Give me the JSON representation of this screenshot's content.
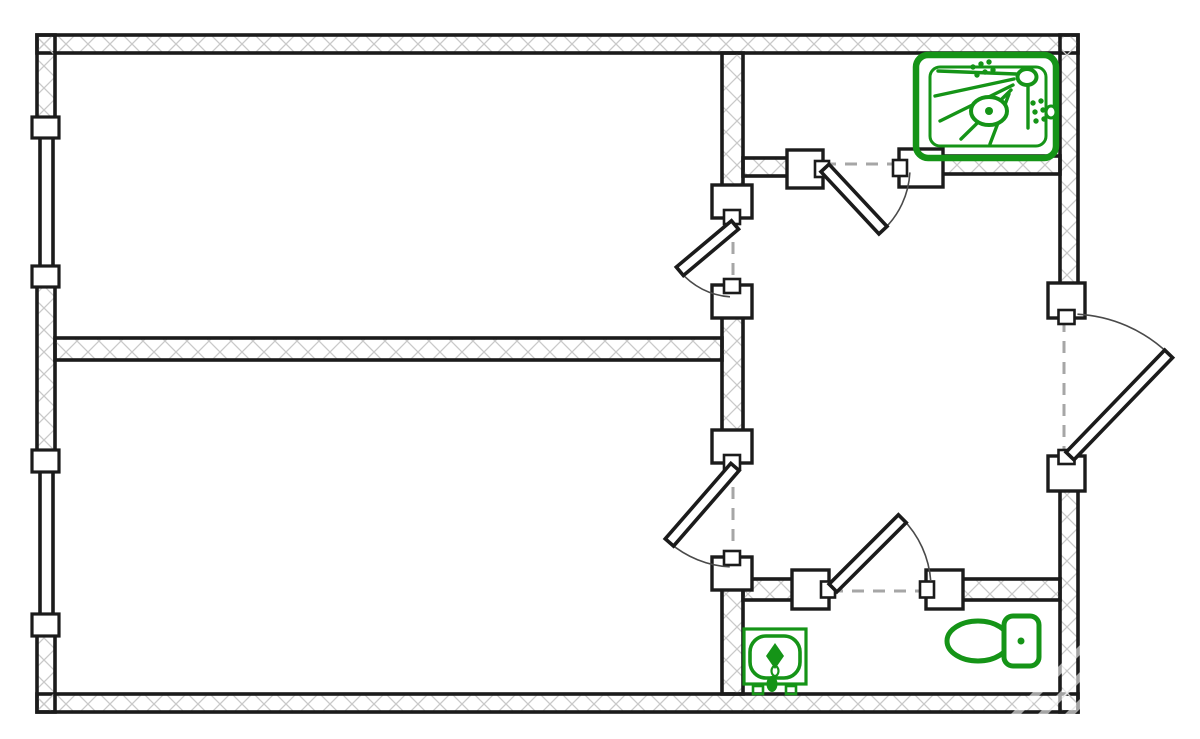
{
  "meta": {
    "name": "apartment-floor-plan",
    "canvas_width": 1200,
    "canvas_height": 739
  },
  "palette": {
    "background": "#ffffff",
    "wall_line": "#1b1b1b",
    "hatch_line": "#c9c9c9",
    "arc_line": "#4a4a4a",
    "dash_line": "#a6a6a6",
    "fixture_green": "#159417",
    "watermark": "#ffffff"
  },
  "plan": {
    "walls": [
      {
        "name": "outer-top",
        "x": 37,
        "y": 35,
        "w": 1041,
        "h": 18
      },
      {
        "name": "outer-bottom",
        "x": 37,
        "y": 694,
        "w": 1041,
        "h": 18
      },
      {
        "name": "outer-left-upper",
        "x": 37,
        "y": 35,
        "w": 18,
        "h": 85
      },
      {
        "name": "outer-left-middle",
        "x": 37,
        "y": 285,
        "w": 18,
        "h": 167
      },
      {
        "name": "outer-left-lower",
        "x": 37,
        "y": 635,
        "w": 18,
        "h": 77
      },
      {
        "name": "outer-right-upper",
        "x": 1060,
        "y": 35,
        "w": 18,
        "h": 250
      },
      {
        "name": "outer-right-lower",
        "x": 1060,
        "y": 489,
        "w": 18,
        "h": 223
      },
      {
        "name": "room-divider-horizontal",
        "x": 55,
        "y": 338,
        "w": 667,
        "h": 22
      },
      {
        "name": "divider-vertical-upper",
        "x": 722,
        "y": 53,
        "w": 21,
        "h": 134
      },
      {
        "name": "divider-vertical-middle",
        "x": 722,
        "y": 316,
        "w": 21,
        "h": 116
      },
      {
        "name": "divider-vertical-lower",
        "x": 722,
        "y": 588,
        "w": 21,
        "h": 106
      },
      {
        "name": "shower-room-wall-left",
        "x": 743,
        "y": 158,
        "w": 46,
        "h": 18
      },
      {
        "name": "shower-room-wall-right",
        "x": 941,
        "y": 156,
        "w": 119,
        "h": 18
      },
      {
        "name": "bathroom-wall-left",
        "x": 743,
        "y": 579,
        "w": 52,
        "h": 21
      },
      {
        "name": "bathroom-wall-right",
        "x": 960,
        "y": 579,
        "w": 100,
        "h": 21
      }
    ],
    "windows": [
      {
        "name": "window-1",
        "x": 35,
        "y": 137,
        "w": 24,
        "h": 131
      },
      {
        "name": "window-2",
        "x": 35,
        "y": 471,
        "w": 24,
        "h": 145
      }
    ],
    "window_jambs": [
      {
        "x": 32,
        "y": 117,
        "w": 27,
        "h": 21
      },
      {
        "x": 32,
        "y": 266,
        "w": 27,
        "h": 21
      },
      {
        "x": 32,
        "y": 450,
        "w": 27,
        "h": 22
      },
      {
        "x": 32,
        "y": 614,
        "w": 27,
        "h": 22
      }
    ],
    "door_jambs": [
      {
        "x": 712,
        "y": 185,
        "w": 40,
        "h": 33,
        "notch": "bottom"
      },
      {
        "x": 712,
        "y": 285,
        "w": 40,
        "h": 33,
        "notch": "top"
      },
      {
        "x": 712,
        "y": 430,
        "w": 40,
        "h": 33,
        "notch": "bottom"
      },
      {
        "x": 712,
        "y": 557,
        "w": 40,
        "h": 33,
        "notch": "top"
      },
      {
        "x": 787,
        "y": 150,
        "w": 36,
        "h": 38,
        "notch": "right"
      },
      {
        "x": 899,
        "y": 149,
        "w": 44,
        "h": 38,
        "notch": "left"
      },
      {
        "x": 792,
        "y": 570,
        "w": 37,
        "h": 39,
        "notch": "right"
      },
      {
        "x": 926,
        "y": 570,
        "w": 37,
        "h": 39,
        "notch": "left"
      },
      {
        "x": 1048,
        "y": 283,
        "w": 37,
        "h": 35,
        "notch": "bottom"
      },
      {
        "x": 1048,
        "y": 456,
        "w": 37,
        "h": 35,
        "notch": "top"
      }
    ],
    "doors": [
      {
        "name": "door-room-1",
        "hinge": [
          735,
          225
        ],
        "len": 72,
        "leaf_deg": 140,
        "arc_deg": 94
      },
      {
        "name": "door-room-2",
        "hinge": [
          735,
          467
        ],
        "len": 100,
        "leaf_deg": 131,
        "arc_deg": 93
      },
      {
        "name": "door-shower-room",
        "hinge": [
          825,
          168
        ],
        "len": 85,
        "leaf_deg": 47,
        "arc_deg": 3
      },
      {
        "name": "door-bathroom",
        "hinge": [
          833,
          588
        ],
        "len": 98,
        "leaf_deg": -45,
        "arc_deg": -4
      },
      {
        "name": "door-entrance",
        "hinge": [
          1070,
          456
        ],
        "len": 142,
        "leaf_deg": -46,
        "arc_deg": -87
      }
    ],
    "thresholds": [
      {
        "name": "threshold-room-1",
        "x1": 733,
        "y1": 221,
        "x2": 733,
        "y2": 283
      },
      {
        "name": "threshold-room-2",
        "x1": 733,
        "y1": 466,
        "x2": 733,
        "y2": 555
      },
      {
        "name": "threshold-shower-room",
        "x1": 824,
        "y1": 164,
        "x2": 897,
        "y2": 164
      },
      {
        "name": "threshold-bathroom",
        "x1": 831,
        "y1": 591,
        "x2": 924,
        "y2": 591
      },
      {
        "name": "threshold-entrance",
        "x1": 1064,
        "y1": 320,
        "x2": 1064,
        "y2": 454
      }
    ],
    "fixtures": [
      {
        "name": "shower-icon",
        "stroke": "#159417",
        "items": [
          {
            "t": "rrect",
            "x": 916,
            "y": 55,
            "w": 140,
            "h": 103,
            "rx": 12,
            "sw": 6.5
          },
          {
            "t": "rrect",
            "x": 930,
            "y": 67,
            "w": 116,
            "h": 79,
            "rx": 10,
            "sw": 3
          },
          {
            "t": "line",
            "x1": 1016,
            "y1": 74,
            "x2": 938,
            "y2": 71,
            "sw": 3.4
          },
          {
            "t": "line",
            "x1": 1014,
            "y1": 79,
            "x2": 935,
            "y2": 96,
            "sw": 3.4
          },
          {
            "t": "line",
            "x1": 1013,
            "y1": 85,
            "x2": 940,
            "y2": 121,
            "sw": 3.4
          },
          {
            "t": "line",
            "x1": 1011,
            "y1": 90,
            "x2": 961,
            "y2": 139,
            "sw": 3.4
          },
          {
            "t": "line",
            "x1": 1009,
            "y1": 94,
            "x2": 990,
            "y2": 144,
            "sw": 3.4
          },
          {
            "t": "line",
            "x1": 1028,
            "y1": 86,
            "x2": 1028,
            "y2": 128,
            "sw": 3.4
          },
          {
            "t": "ellipse",
            "cx": 989,
            "cy": 111,
            "rx": 18,
            "ry": 14,
            "sw": 4,
            "fill": "#ffffff"
          },
          {
            "t": "dot",
            "cx": 989,
            "cy": 111,
            "r": 4
          },
          {
            "t": "ellipse",
            "cx": 1027,
            "cy": 77,
            "rx": 9.5,
            "ry": 8,
            "sw": 4,
            "fill": "#ffffff"
          },
          {
            "t": "ellipse",
            "cx": 1051,
            "cy": 112,
            "rx": 5,
            "ry": 6,
            "sw": 3,
            "fill": "#ffffff"
          },
          {
            "t": "dots",
            "r": 2.7,
            "pts": [
              [
                973,
                67
              ],
              [
                981,
                64
              ],
              [
                989,
                62
              ],
              [
                977,
                75
              ],
              [
                985,
                72
              ],
              [
                993,
                70
              ],
              [
                1033,
                103
              ],
              [
                1041,
                101
              ],
              [
                1035,
                112
              ],
              [
                1043,
                110
              ],
              [
                1036,
                121
              ],
              [
                1044,
                119
              ]
            ]
          }
        ]
      },
      {
        "name": "sink-icon",
        "stroke": "#159417",
        "items": [
          {
            "t": "rect",
            "x": 744,
            "y": 629,
            "w": 62,
            "h": 55,
            "sw": 3.2
          },
          {
            "t": "rrect",
            "x": 750,
            "y": 636,
            "w": 50,
            "h": 42,
            "rx": 16,
            "sw": 3.6
          },
          {
            "t": "poly",
            "pts": [
              [
                775,
                643
              ],
              [
                784,
                656
              ],
              [
                775,
                669
              ],
              [
                766,
                656
              ]
            ],
            "fill": "self"
          },
          {
            "t": "ellipse",
            "cx": 775,
            "cy": 671,
            "rx": 3.5,
            "ry": 5,
            "sw": 2.2
          },
          {
            "t": "ellipse",
            "cx": 772,
            "cy": 684,
            "rx": 5.5,
            "ry": 8,
            "fill": "self"
          },
          {
            "t": "rect",
            "x": 753,
            "y": 686,
            "w": 10,
            "h": 8,
            "sw": 2.6
          },
          {
            "t": "rect",
            "x": 786,
            "y": 686,
            "w": 10,
            "h": 8,
            "sw": 2.6
          }
        ]
      },
      {
        "name": "toilet-icon",
        "stroke": "#159417",
        "items": [
          {
            "t": "ellipse",
            "cx": 978,
            "cy": 641,
            "rx": 31,
            "ry": 20,
            "sw": 5,
            "fill": "#ffffff"
          },
          {
            "t": "rrect",
            "x": 1004,
            "y": 616,
            "w": 35,
            "h": 50,
            "rx": 9,
            "sw": 5,
            "fill": "#ffffff"
          },
          {
            "t": "dot",
            "cx": 1021,
            "cy": 641,
            "r": 3.5
          }
        ]
      }
    ],
    "watermark": {
      "x_start": 985,
      "y_start": 745,
      "spacing": 27,
      "count": 9,
      "dx": 220,
      "dy": -220,
      "sw": 7,
      "opacity": 0.6
    }
  }
}
